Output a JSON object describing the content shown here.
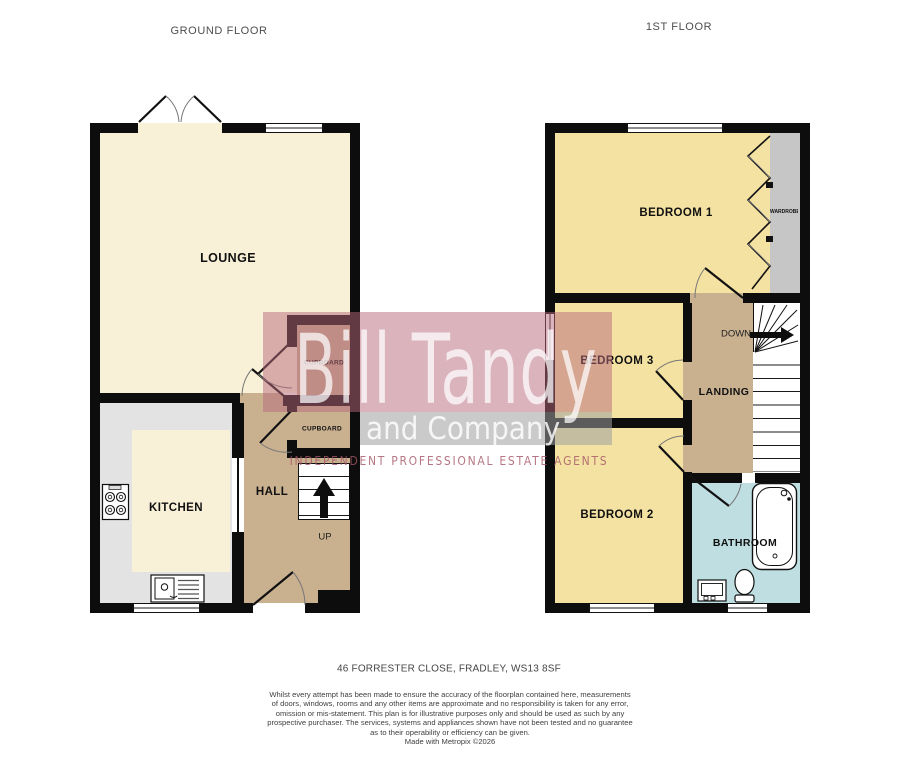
{
  "titles": {
    "ground": "GROUND FLOOR",
    "first": "1ST FLOOR"
  },
  "rooms": {
    "lounge": "LOUNGE",
    "kitchen": "KITCHEN",
    "hall": "HALL",
    "cupboard1": "CUPBOARD",
    "cupboard2": "CUPBOARD",
    "up": "UP",
    "bedroom1": "BEDROOM 1",
    "bedroom3": "BEDROOM 3",
    "bedroom2": "BEDROOM 2",
    "landing": "LANDING",
    "bathroom": "BATHROOM",
    "down": "DOWN",
    "wardrobe": "WARDROBE"
  },
  "watermark": {
    "brand_line1": "Bill Tandy",
    "brand_line2": "and Company",
    "tagline": "INDEPENDENT PROFESSIONAL ESTATE AGENTS"
  },
  "footer": {
    "address": "46 FORRESTER CLOSE, FRADLEY, WS13 8SF",
    "disclaimer": [
      "Whilst every attempt has been made to ensure the accuracy of the floorplan contained here, measurements",
      "of doors, windows, rooms and any other items are approximate and no responsibility is taken for any error,",
      "omission or mis-statement. This plan is for illustrative purposes only and should be used as such by any",
      "prospective purchaser. The services, systems and appliances shown have not been tested and no guarantee",
      "as to their operability or efficiency can be given.",
      "Made with Metropix ©2026"
    ]
  },
  "colors": {
    "wall": "#0d0d0d",
    "lounge": "#f8f1d7",
    "bedroom": "#f4e2a2",
    "hall": "#c9b190",
    "kitchen_floor": "#e3e3e3",
    "bathroom": "#bedee2",
    "wardrobe": "#c6c6c6",
    "wm_pink": "#b5677c",
    "wm_gray": "#9e9e9e"
  }
}
